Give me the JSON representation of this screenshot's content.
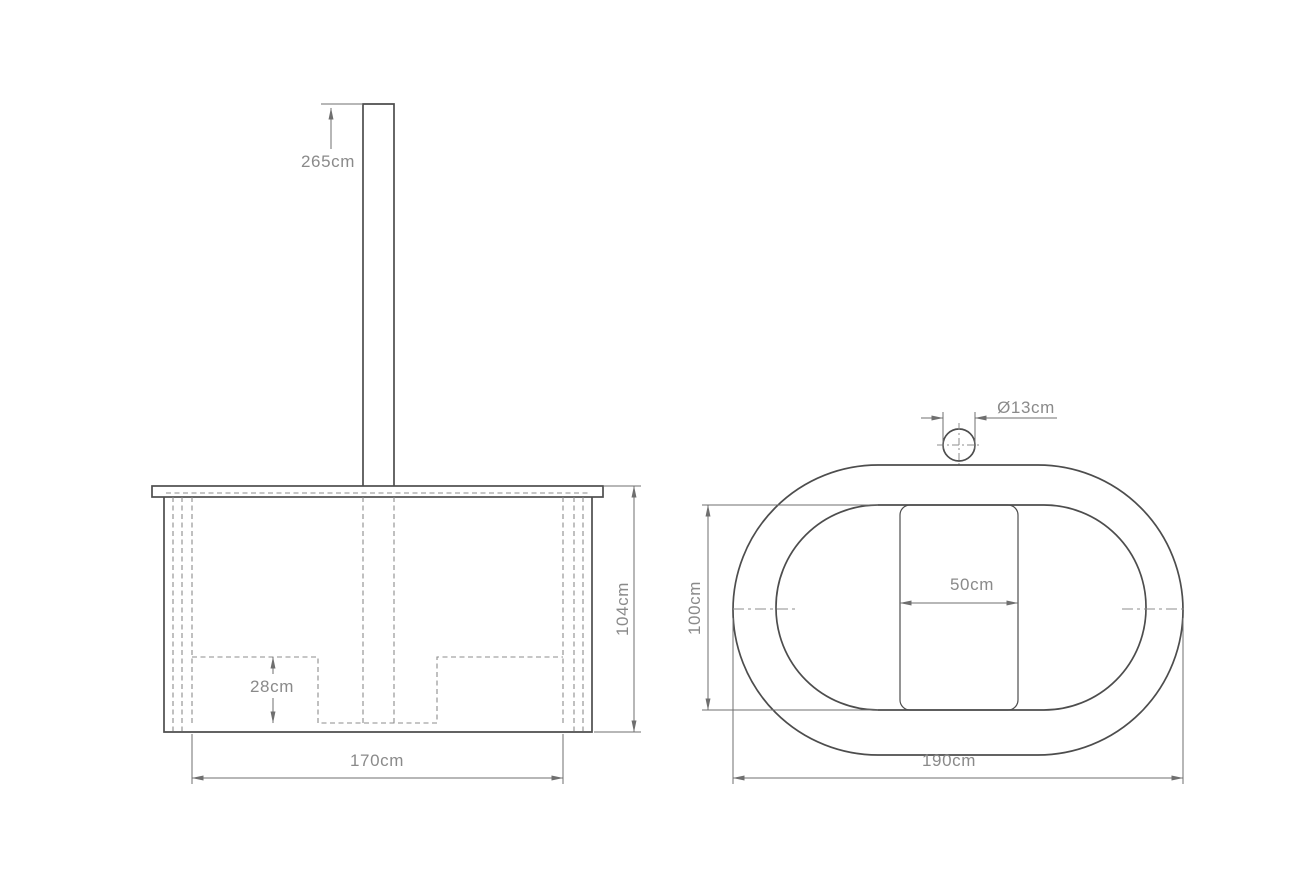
{
  "drawing": {
    "front_view": {
      "dimensions": {
        "chimney_height": "265cm",
        "tub_height": "104cm",
        "seat_height": "28cm",
        "tub_width": "170cm"
      }
    },
    "plan_view": {
      "dimensions": {
        "chimney_diameter": "Ø13cm",
        "inner_width": "100cm",
        "stove_width": "50cm",
        "outer_length": "190cm"
      }
    },
    "colors": {
      "background": "#ffffff",
      "outline": "#4d4d4d",
      "dimension_line": "#6f6f6f",
      "hidden_line": "#8d8d8d",
      "label_text": "#8a8a8a"
    }
  }
}
